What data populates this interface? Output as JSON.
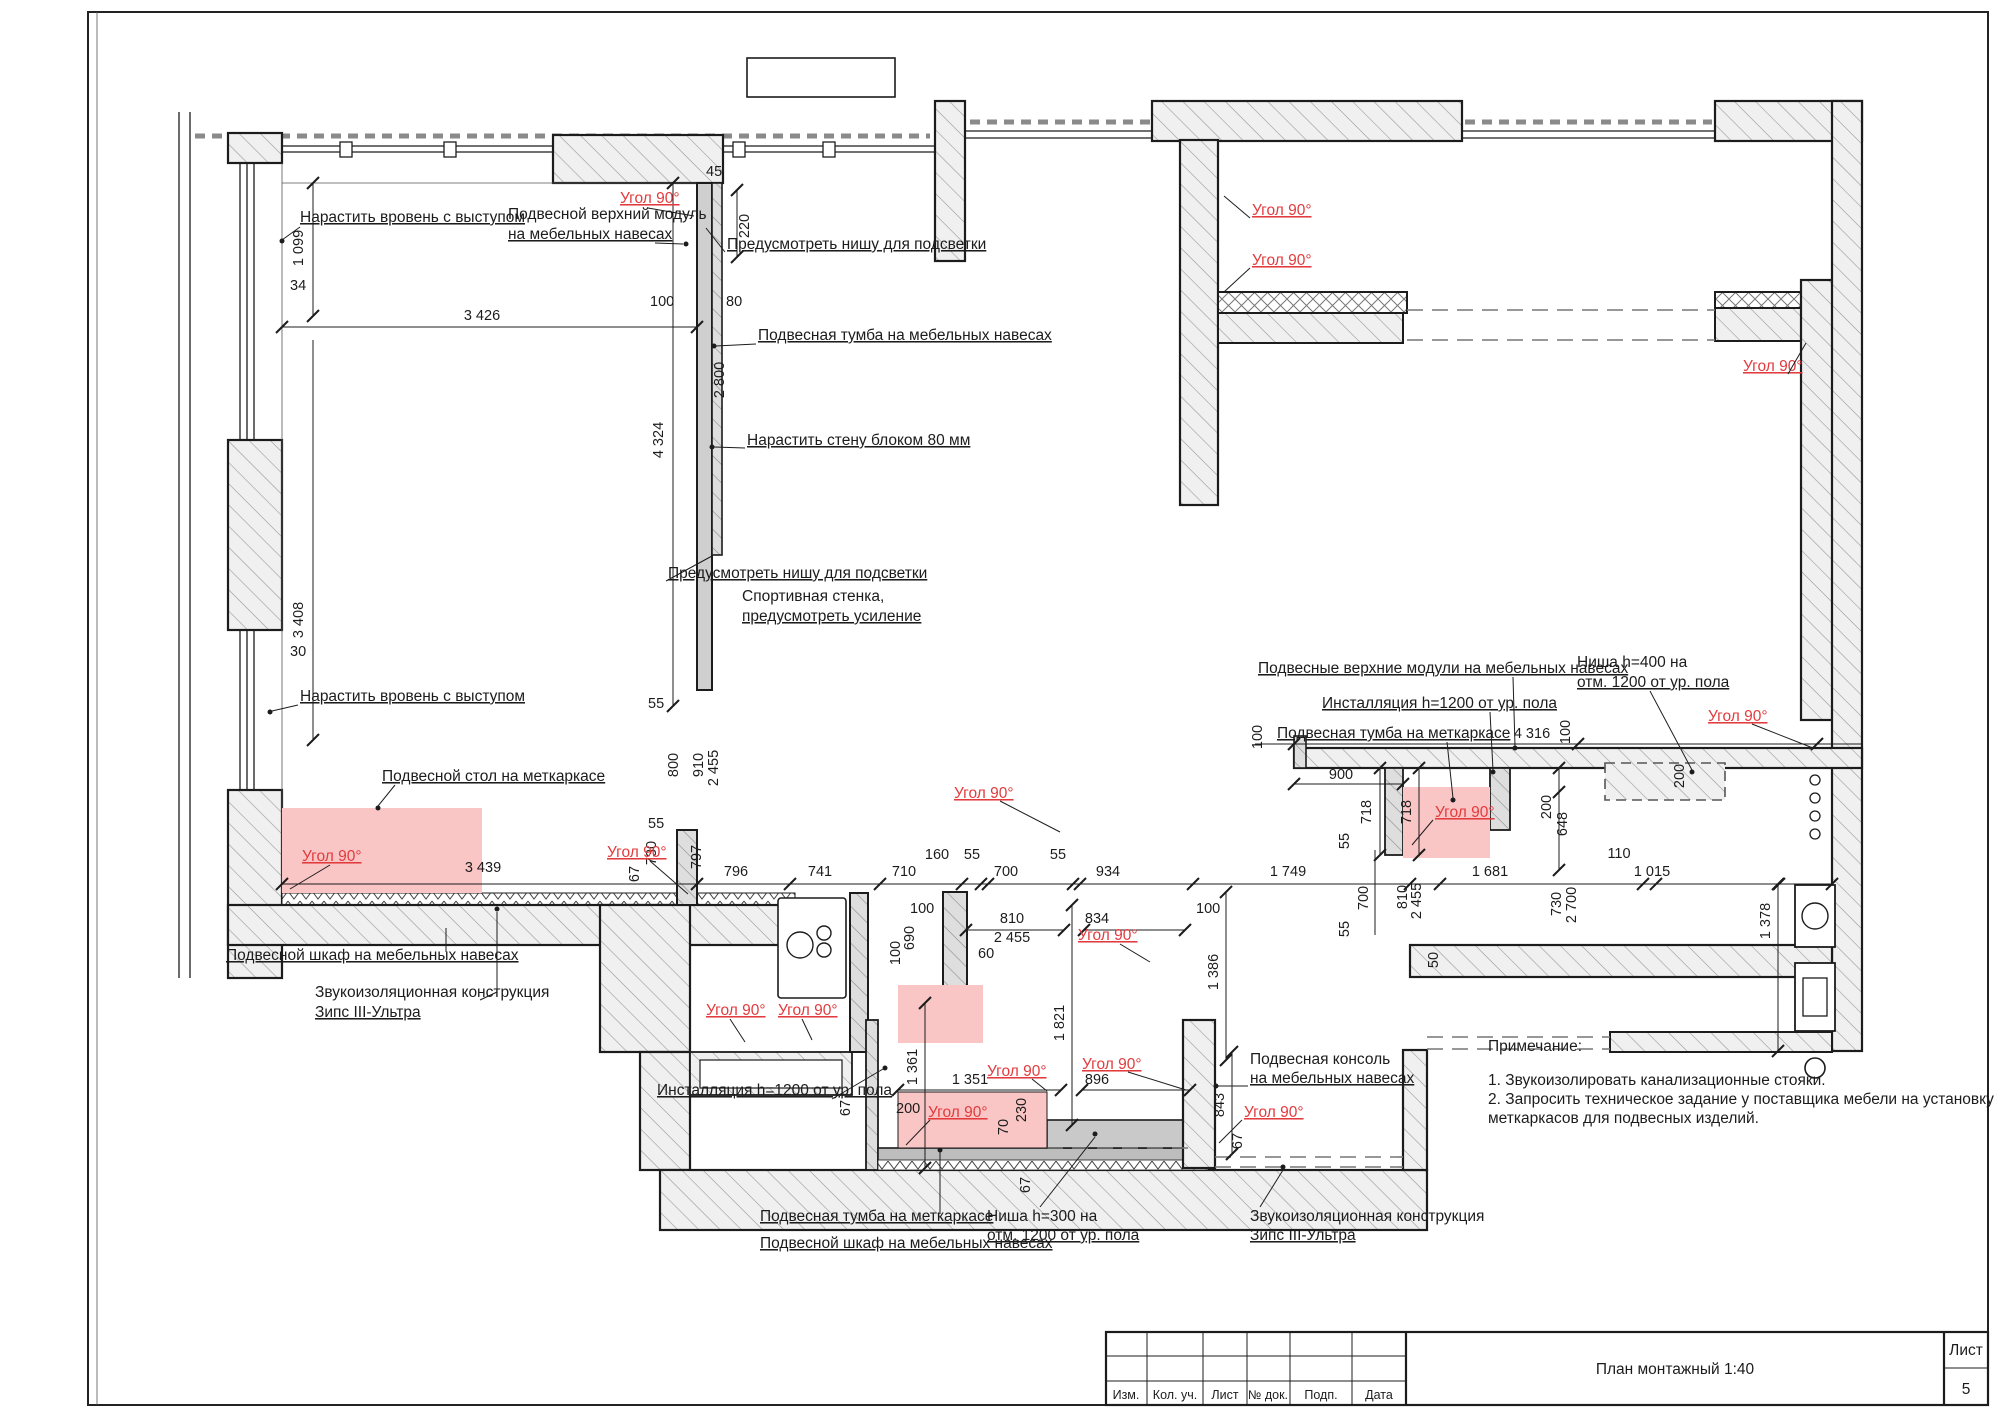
{
  "colors": {
    "accent_red": "#e23b3e",
    "highlight_pink": "#f9c5c5",
    "wall_fill": "#efefef"
  },
  "labels": {
    "ugol90": "Угол 90°",
    "extend_flush": "Нарастить вровень с выступом",
    "upper_module_1": "Подвесной верхний модуль",
    "upper_module_2": "на мебельных навесах",
    "niche_light": "Предусмотреть нишу для подсветки",
    "hang_tumba_furn": "Подвесная тумба на мебельных навесах",
    "extend_block": "Нарастить стену блоком 80 мм",
    "sport_1": "Спортивная стенка,",
    "sport_2": "предусмотреть усиление",
    "hang_table": "Подвесной стол на меткаркасе",
    "hang_cab_furn": "Подвесной шкаф на мебельных навесах",
    "sound_1": "Звукоизоляционная конструкция",
    "sound_2": "Зипс III-Ультра",
    "installation": "Инсталляция h=1200 от ур. пола",
    "hang_tumba_frame": "Подвесная тумба на меткаркасе",
    "niche300_1": "Ниша h=300 на",
    "niche300_2": "отм. 1200 от ур. пола",
    "console_1": "Подвесная консоль",
    "console_2": "на мебельных навесах",
    "upper_modules_right": "Подвесные верхние модули на мебельных навесах",
    "niche400_1": "Ниша h=400 на",
    "niche400_2": "отм. 1200 от ур. пола"
  },
  "notes": {
    "heading": "Примечание:",
    "item1": "1. Звукоизолировать канализационные стояки.",
    "item2": "2. Запросить техническое задание у поставщика мебели на установку",
    "item3": "меткаркасов для подвесных изделий."
  },
  "dims": {
    "n30": "30",
    "n34": "34",
    "n45": "45",
    "n50": "50",
    "n55": "55",
    "n60": "60",
    "n67": "67",
    "n70": "70",
    "n80": "80",
    "n100": "100",
    "n110": "110",
    "n160": "160",
    "n200": "200",
    "n220": "220",
    "n230": "230",
    "n648": "648",
    "n690": "690",
    "n700": "700",
    "n710": "710",
    "n718": "718",
    "n730": "730",
    "n741": "741",
    "n796": "796",
    "n797": "797",
    "n800": "800",
    "n810": "810",
    "n834": "834",
    "n843": "843",
    "n896": "896",
    "n900": "900",
    "n910": "910",
    "n934": "934",
    "n1015": "1 015",
    "n1099": "1 099",
    "n1351": "1 351",
    "n1361": "1 361",
    "n1378": "1 378",
    "n1386": "1 386",
    "n1681": "1 681",
    "n1749": "1 749",
    "n1821": "1 821",
    "n2455": "2 455",
    "n2700": "2 700",
    "n2800": "2 800",
    "n3408": "3 408",
    "n3426": "3 426",
    "n3439": "3 439",
    "n4316": "4 316",
    "n4324": "4 324"
  },
  "title_block": {
    "title": "План монтажный 1:40",
    "sheet_label": "Лист",
    "sheet_number": "5",
    "col1": "Изм.",
    "col2": "Кол. уч.",
    "col3": "Лист",
    "col4": "№ док.",
    "col5": "Подп.",
    "col6": "Дата"
  }
}
